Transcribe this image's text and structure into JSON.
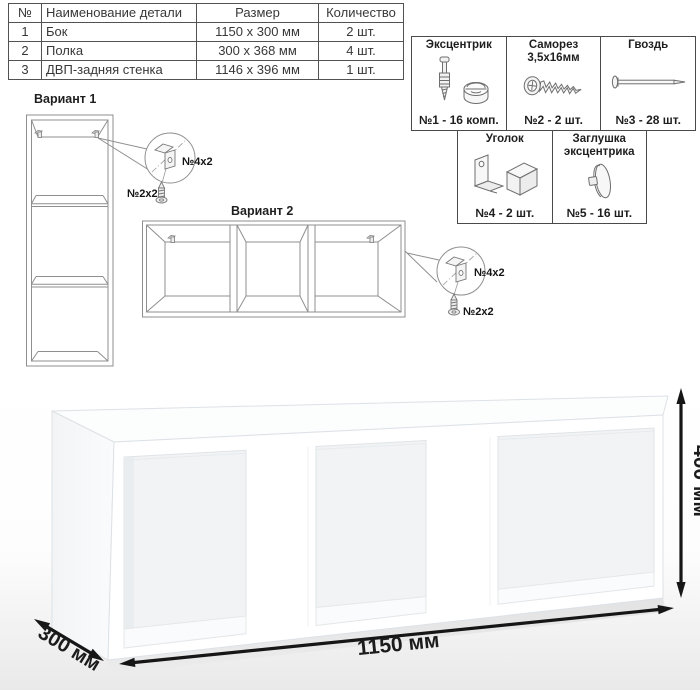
{
  "parts_table": {
    "headers": [
      "№",
      "Наименование детали",
      "Размер",
      "Количество"
    ],
    "rows": [
      {
        "num": "1",
        "name": "Бок",
        "size": "1150 x 300 мм",
        "qty": "2 шт."
      },
      {
        "num": "2",
        "name": "Полка",
        "size": "300 x 368 мм",
        "qty": "4 шт."
      },
      {
        "num": "3",
        "name": "ДВП-задняя стенка",
        "size": "1146 x 396 мм",
        "qty": "1 шт."
      }
    ]
  },
  "hardware": {
    "cells": [
      {
        "title_line1": "Эксцентрик",
        "title_line2": "",
        "caption": "№1 - 16 комп.",
        "icon": "cam-bolt-icon"
      },
      {
        "title_line1": "Саморез",
        "title_line2": "3,5х16мм",
        "caption": "№2 - 2 шт.",
        "icon": "screw-icon"
      },
      {
        "title_line1": "Гвоздь",
        "title_line2": "",
        "caption": "№3 - 28 шт.",
        "icon": "nail-icon"
      },
      {
        "title_line1": "Уголок",
        "title_line2": "",
        "caption": "№4 - 2 шт.",
        "icon": "corner-bracket-icon"
      },
      {
        "title_line1": "Заглушка",
        "title_line2": "эксцентрика",
        "caption": "№5 - 16 шт.",
        "icon": "cam-cap-icon"
      }
    ]
  },
  "variant1": {
    "title": "Вариант 1",
    "bracket_label": "№4х2",
    "screw_label": "№2х2"
  },
  "variant2": {
    "title": "Вариант 2",
    "bracket_label": "№4х2",
    "screw_label": "№2х2"
  },
  "dimensions": {
    "width_label": "1150 мм",
    "depth_label": "300 мм",
    "height_label": "400 мм"
  },
  "colors": {
    "line_art": "#8f8f8f",
    "ink": "#1c1c1c",
    "table_border": "#525252",
    "opening_fill": "#f1f3f5"
  }
}
